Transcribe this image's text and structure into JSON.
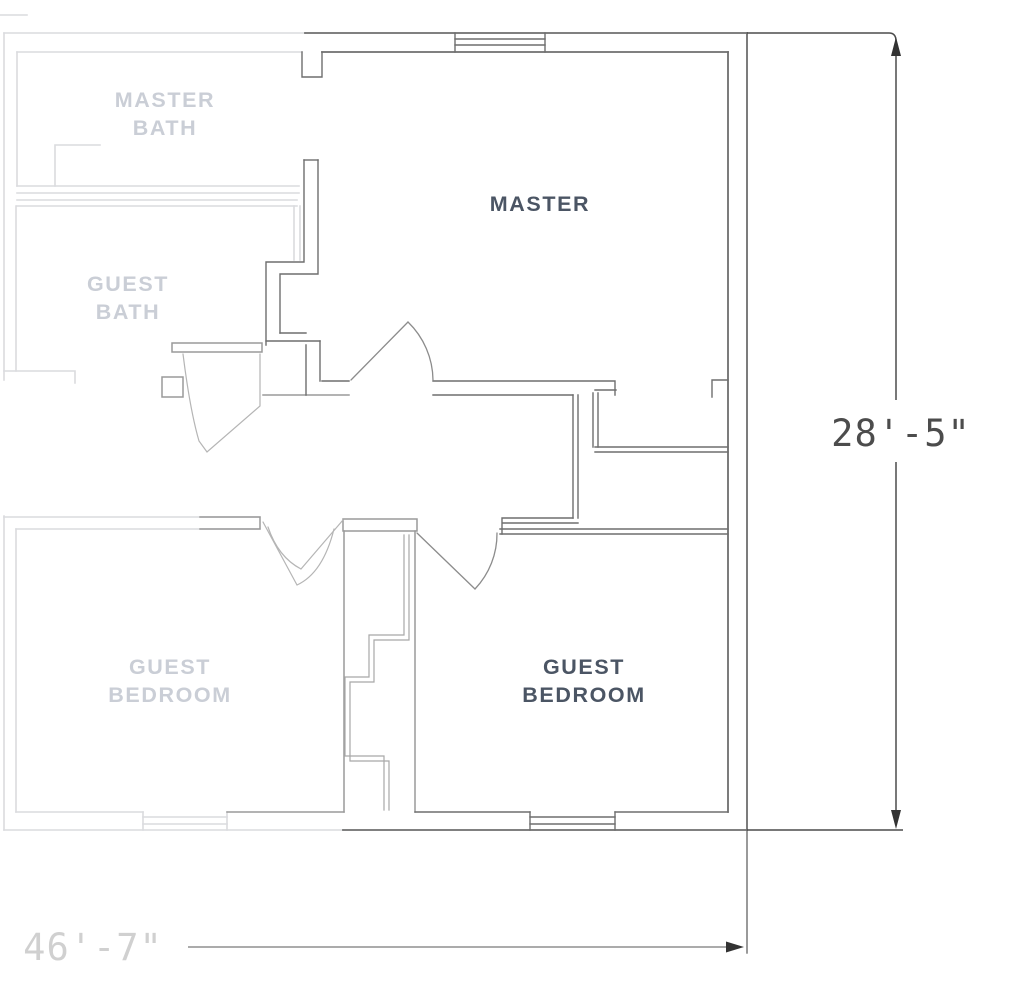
{
  "title": "Floor plan",
  "rooms": {
    "master_bath": {
      "line1": "MASTER",
      "line2": "BATH",
      "emphasis": "faded"
    },
    "guest_bath": {
      "line1": "GUEST",
      "line2": "BATH",
      "emphasis": "faded"
    },
    "master": {
      "line1": "MASTER",
      "line2": "",
      "emphasis": "dark"
    },
    "guest_bedroom_left": {
      "line1": "GUEST",
      "line2": "BEDROOM",
      "emphasis": "faded"
    },
    "guest_bedroom_right": {
      "line1": "GUEST",
      "line2": "BEDROOM",
      "emphasis": "dark"
    }
  },
  "dimensions": {
    "height_label": "28'-5\"",
    "width_label": "46'-7\""
  },
  "colors": {
    "wall-dark": "#6e6e6e",
    "wall-med": "#9a9a9a",
    "wall-faded": "#dadbde",
    "label-dark": "#4b5564",
    "label-faaded": "#caced6",
    "dim-dark": "#4c4c4c",
    "dim-faded": "#d0d0d0",
    "background": "#ffffff"
  }
}
